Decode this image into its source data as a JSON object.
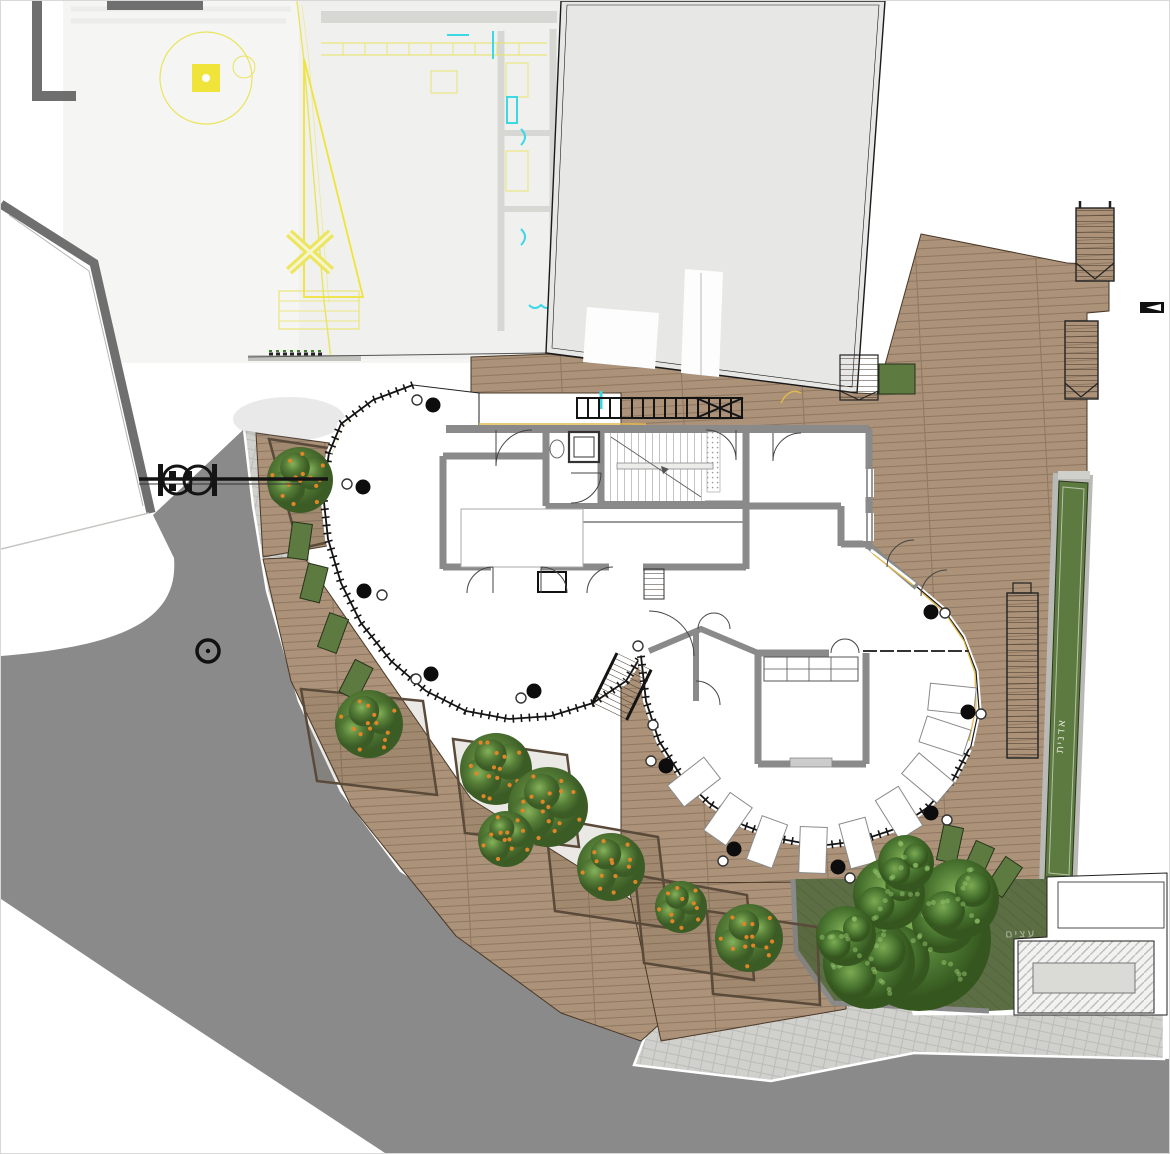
{
  "drawing": {
    "kind": "architectural-site-plan",
    "labels": {
      "planter_strip": "אדנית",
      "lawn_trees": "עצים"
    }
  },
  "colors": {
    "page": "#ffffff",
    "cad_bg": "#f5f5f3",
    "cad_bg2": "#f0f0ee",
    "cad_yellow": "#e9e45e",
    "cad_yellow_strong": "#f0e33a",
    "cad_cyan": "#3cd8e6",
    "accent_yellow": "#e2b94c",
    "road": "#8a8a8a",
    "paver": "#d0d0cc",
    "deck": "#ab9279",
    "deck_edge": "#4a3827",
    "lawn": "#5c6e44",
    "planter_green": "#5d7a40",
    "planter_wall": "#5a4a3a",
    "wall": "#8a8a8a",
    "wall_dark": "#6f6f6f",
    "roof": "#e7e7e5",
    "rail": "#141414",
    "tree_orange_fruit": "#df8628",
    "white": "#ffffff"
  },
  "columns": [
    [
      432,
      404
    ],
    [
      362,
      486
    ],
    [
      363,
      590
    ],
    [
      430,
      673
    ],
    [
      533,
      690
    ],
    [
      665,
      765
    ],
    [
      733,
      848
    ],
    [
      837,
      866
    ],
    [
      930,
      812
    ],
    [
      967,
      711
    ],
    [
      930,
      611
    ]
  ],
  "column_markers": [
    [
      416,
      399
    ],
    [
      346,
      483
    ],
    [
      381,
      594
    ],
    [
      415,
      678
    ],
    [
      520,
      697
    ],
    [
      650,
      760
    ],
    [
      722,
      860
    ],
    [
      849,
      877
    ],
    [
      946,
      819
    ],
    [
      980,
      713
    ],
    [
      944,
      612
    ],
    [
      637,
      645
    ],
    [
      652,
      724
    ]
  ],
  "sunbeds": [
    [
      693,
      781,
      -38
    ],
    [
      727,
      818,
      -55
    ],
    [
      766,
      841,
      -70
    ],
    [
      812,
      849,
      -88
    ],
    [
      857,
      842,
      75
    ],
    [
      898,
      812,
      58
    ],
    [
      927,
      777,
      40
    ],
    [
      944,
      735,
      18
    ],
    [
      951,
      698,
      6
    ]
  ],
  "orange_trees": [
    [
      299,
      479,
      33
    ],
    [
      368,
      723,
      34
    ],
    [
      495,
      768,
      36
    ],
    [
      547,
      806,
      40
    ],
    [
      505,
      838,
      28
    ],
    [
      610,
      866,
      34
    ],
    [
      680,
      906,
      26
    ],
    [
      748,
      937,
      34
    ]
  ],
  "lawn_tree_blobs": [
    [
      918,
      938,
      72
    ],
    [
      868,
      962,
      46
    ],
    [
      958,
      898,
      40
    ],
    [
      888,
      893,
      36
    ],
    [
      905,
      862,
      28
    ],
    [
      845,
      935,
      30
    ]
  ],
  "planter_boxes": [
    [
      299,
      540,
      8
    ],
    [
      313,
      582,
      14
    ],
    [
      332,
      632,
      20
    ],
    [
      355,
      679,
      27
    ],
    [
      381,
      722,
      33
    ],
    [
      949,
      843,
      12
    ],
    [
      977,
      860,
      24
    ],
    [
      1003,
      876,
      34
    ]
  ],
  "planter_bed_outlines": [
    "268,438 347,450 353,535 298,548",
    "300,688 422,700 436,794 316,780",
    "452,738 566,754 578,846 464,832",
    "544,816 657,836 668,927 554,910",
    "634,874 746,894 753,979 643,962",
    "706,910 816,926 819,1004 712,993"
  ],
  "symbols": {
    "gate": "double-gate-valve-symbol",
    "manhole": "manhole-cover",
    "marker": "section-marker"
  }
}
